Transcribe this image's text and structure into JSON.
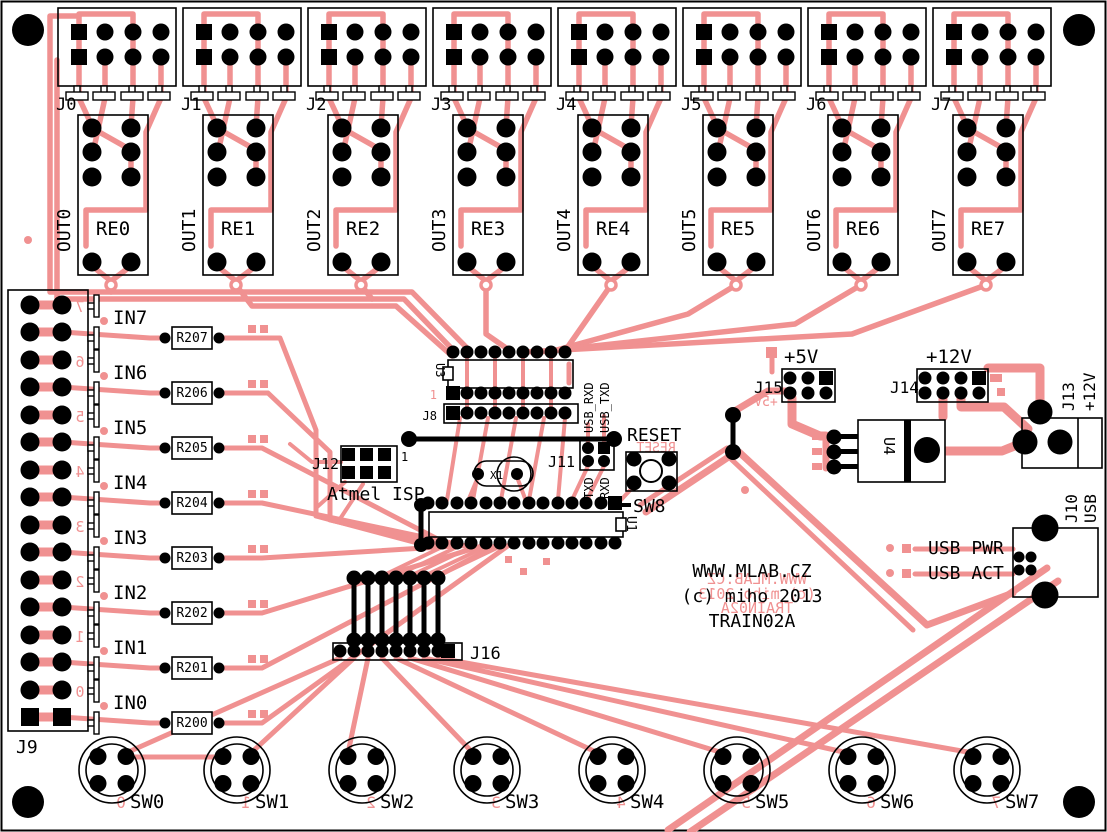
{
  "board": {
    "colors": {
      "copper": "#f09191",
      "silkscreen": "#000000",
      "background": "#ffffff",
      "pad": "#000000"
    }
  },
  "branding": {
    "line1": "WWW.MLAB.CZ",
    "line2": "(c) miho 2013",
    "line3": "TRAIN02A",
    "mirror1": "WWW.MLAB.CZ",
    "mirror2": "(c) miho 2013",
    "mirror3": "TRAIN02A"
  },
  "relays": [
    {
      "connector": "J0",
      "name": "RE0",
      "output": "OUT0"
    },
    {
      "connector": "J1",
      "name": "RE1",
      "output": "OUT1"
    },
    {
      "connector": "J2",
      "name": "RE2",
      "output": "OUT2"
    },
    {
      "connector": "J3",
      "name": "RE3",
      "output": "OUT3"
    },
    {
      "connector": "J4",
      "name": "RE4",
      "output": "OUT4"
    },
    {
      "connector": "J5",
      "name": "RE5",
      "output": "OUT5"
    },
    {
      "connector": "J6",
      "name": "RE6",
      "output": "OUT6"
    },
    {
      "connector": "J7",
      "name": "RE7",
      "output": "OUT7"
    }
  ],
  "j9": {
    "label": "J9"
  },
  "inputs": [
    {
      "name": "IN7",
      "resistor": "R207",
      "digit": "7"
    },
    {
      "name": "IN6",
      "resistor": "R206",
      "digit": "6"
    },
    {
      "name": "IN5",
      "resistor": "R205",
      "digit": "5"
    },
    {
      "name": "IN4",
      "resistor": "R204",
      "digit": "4"
    },
    {
      "name": "IN3",
      "resistor": "R203",
      "digit": "3"
    },
    {
      "name": "IN2",
      "resistor": "R202",
      "digit": "2"
    },
    {
      "name": "IN1",
      "resistor": "R201",
      "digit": "1"
    },
    {
      "name": "IN0",
      "resistor": "R200",
      "digit": "0"
    }
  ],
  "switches": [
    {
      "name": "SW0",
      "digit": "0"
    },
    {
      "name": "SW1",
      "digit": "1"
    },
    {
      "name": "SW2",
      "digit": "2"
    },
    {
      "name": "SW3",
      "digit": "3"
    },
    {
      "name": "SW4",
      "digit": "4"
    },
    {
      "name": "SW5",
      "digit": "5"
    },
    {
      "name": "SW6",
      "digit": "6"
    },
    {
      "name": "SW7",
      "digit": "7"
    }
  ],
  "u3": {
    "label": "U3",
    "pin1": "1"
  },
  "u1": {
    "label": "U1"
  },
  "u4": {
    "label": "U4"
  },
  "x1": {
    "label": "X1"
  },
  "j8": {
    "label": "J8"
  },
  "j11": {
    "label": "J11"
  },
  "j12": {
    "label": "J12",
    "pin1": "1"
  },
  "isp": {
    "label": "Atmel ISP"
  },
  "j16": {
    "label": "J16"
  },
  "serial": {
    "usb_rxd": "USB_RXD",
    "usb_txd": "USB_TXD",
    "txd": "TXD",
    "rxd": "RXD"
  },
  "reset": {
    "label": "RESET",
    "mirror": "RESET",
    "switch": "SW8"
  },
  "power": {
    "j15": "J15",
    "plus5": "+5V",
    "plus5_mirror": "+5V",
    "j14": "J14",
    "plus12": "+12V",
    "j13": "J13",
    "j13_voltage": "+12V",
    "j10": "J10",
    "j10_usb": "USB",
    "usb_pwr": "USB PWR",
    "usb_act": "USB ACT"
  }
}
